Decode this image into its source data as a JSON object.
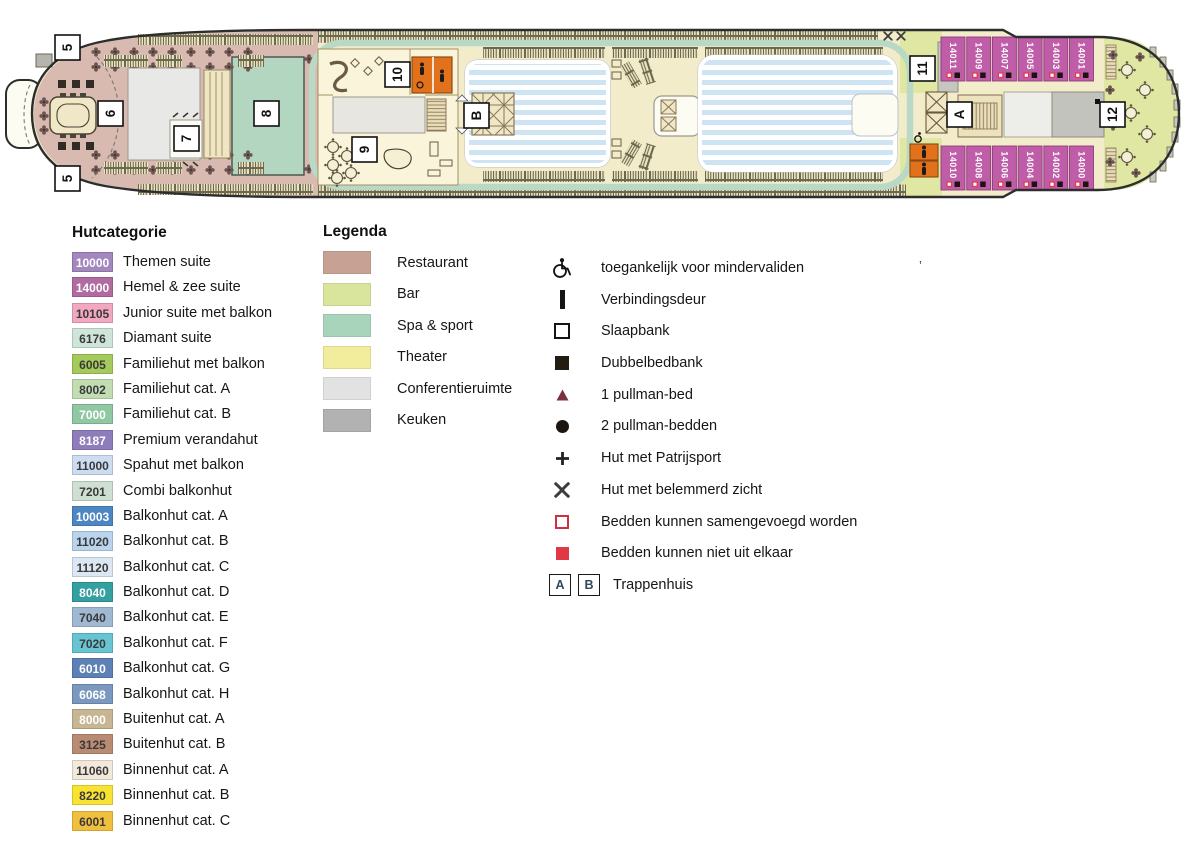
{
  "deck_plan": {
    "markers": [
      {
        "label": "5",
        "x": 55,
        "y": 35
      },
      {
        "label": "5",
        "x": 55,
        "y": 166
      },
      {
        "label": "6",
        "x": 98,
        "y": 101
      },
      {
        "label": "7",
        "x": 174,
        "y": 126
      },
      {
        "label": "8",
        "x": 254,
        "y": 101
      },
      {
        "label": "9",
        "x": 352,
        "y": 137
      },
      {
        "label": "10",
        "x": 385,
        "y": 62
      },
      {
        "label": "11",
        "x": 910,
        "y": 56
      },
      {
        "label": "12",
        "x": 1100,
        "y": 102
      },
      {
        "label": "A",
        "x": 947,
        "y": 102
      },
      {
        "label": "B",
        "x": 464,
        "y": 103
      }
    ],
    "cabins_top": [
      "14011",
      "14009",
      "14007",
      "14005",
      "14003",
      "14001"
    ],
    "cabins_bottom": [
      "14010",
      "14008",
      "14006",
      "14004",
      "14002",
      "14000"
    ],
    "colors": {
      "hull_outline": "#2d2d2d",
      "deck": "#f2ecca",
      "restaurant_area": "#d8bab0",
      "bar_area": "#dfe7a2",
      "spa_area": "#b2d6c0",
      "venue_area": "#faf4da",
      "pool_blue": "#cfe4f3",
      "jogging_track": "#b9d8c5",
      "cabin_suite": "#c05da8",
      "wc_orange": "#e2711c",
      "conference_gray": "#e8e8e6",
      "kitchen_gray": "#c3c3bd",
      "marker_red": "#e8384a"
    }
  },
  "hutcategorie": {
    "title": "Hutcategorie",
    "items": [
      {
        "code": "10000",
        "label": "Themen suite",
        "bg": "#a288bf",
        "fg": "#ffffff"
      },
      {
        "code": "14000",
        "label": "Hemel & zee suite",
        "bg": "#b16ba1",
        "fg": "#ffffff"
      },
      {
        "code": "10105",
        "label": "Junior suite met balkon",
        "bg": "#f2a8c0",
        "fg": "#3a3a3a"
      },
      {
        "code": "6176",
        "label": "Diamant suite",
        "bg": "#cfe5d9",
        "fg": "#3a3a3a"
      },
      {
        "code": "6005",
        "label": "Familiehut met balkon",
        "bg": "#a3ca5b",
        "fg": "#3a3a3a"
      },
      {
        "code": "8002",
        "label": "Familiehut cat. A",
        "bg": "#c2ddb1",
        "fg": "#3a3a3a"
      },
      {
        "code": "7000",
        "label": "Familiehut cat. B",
        "bg": "#90c8a4",
        "fg": "#ffffff"
      },
      {
        "code": "8187",
        "label": "Premium verandahut",
        "bg": "#8f7cba",
        "fg": "#ffffff"
      },
      {
        "code": "11000",
        "label": "Spahut met balkon",
        "bg": "#ccdcf1",
        "fg": "#3a3a3a"
      },
      {
        "code": "7201",
        "label": "Combi balkonhut",
        "bg": "#cfdfd2",
        "fg": "#3a3a3a"
      },
      {
        "code": "10003",
        "label": "Balkonhut cat. A",
        "bg": "#4c86c3",
        "fg": "#ffffff"
      },
      {
        "code": "11020",
        "label": "Balkonhut cat. B",
        "bg": "#b9d4ec",
        "fg": "#3a3a3a"
      },
      {
        "code": "11120",
        "label": "Balkonhut cat. C",
        "bg": "#dde7f3",
        "fg": "#3a3a3a"
      },
      {
        "code": "8040",
        "label": "Balkonhut cat. D",
        "bg": "#34a0a0",
        "fg": "#ffffff"
      },
      {
        "code": "7040",
        "label": "Balkonhut cat. E",
        "bg": "#a0b8d1",
        "fg": "#3a3a3a"
      },
      {
        "code": "7020",
        "label": "Balkonhut cat. F",
        "bg": "#66c4d3",
        "fg": "#3a3a3a"
      },
      {
        "code": "6010",
        "label": "Balkonhut cat. G",
        "bg": "#5d80b5",
        "fg": "#ffffff"
      },
      {
        "code": "6068",
        "label": "Balkonhut cat. H",
        "bg": "#7b98bf",
        "fg": "#ffffff"
      },
      {
        "code": "8000",
        "label": "Buitenhut cat. A",
        "bg": "#c7b694",
        "fg": "#ffffff"
      },
      {
        "code": "3125",
        "label": "Buitenhut cat. B",
        "bg": "#ba8b73",
        "fg": "#3a3a3a"
      },
      {
        "code": "11060",
        "label": "Binnenhut cat. A",
        "bg": "#f3e9da",
        "fg": "#3a3a3a"
      },
      {
        "code": "8220",
        "label": "Binnenhut cat. B",
        "bg": "#f9e332",
        "fg": "#3a3a3a"
      },
      {
        "code": "6001",
        "label": "Binnenhut cat. C",
        "bg": "#f1bf3e",
        "fg": "#3a3a3a"
      }
    ]
  },
  "legenda": {
    "title": "Legenda",
    "items": [
      {
        "label": "Restaurant",
        "color": "#c7a294"
      },
      {
        "label": "Bar",
        "color": "#d9e49c"
      },
      {
        "label": "Spa & sport",
        "color": "#a9d4bc"
      },
      {
        "label": "Theater",
        "color": "#f2ec9d"
      },
      {
        "label": "Conferentieruimte",
        "color": "#e2e2e2"
      },
      {
        "label": "Keuken",
        "color": "#b2b2b2"
      }
    ]
  },
  "symbols": {
    "items": [
      {
        "icon": "wheelchair-icon",
        "label": "toegankelijk voor mindervaliden"
      },
      {
        "icon": "door-bar-icon",
        "label": "Verbindingsdeur"
      },
      {
        "icon": "square-outline-icon",
        "label": "Slaapbank"
      },
      {
        "icon": "square-filled-icon",
        "label": "Dubbelbedbank"
      },
      {
        "icon": "triangle-icon",
        "label": "1 pullman-bed"
      },
      {
        "icon": "circle-icon",
        "label": "2 pullman-bedden"
      },
      {
        "icon": "plus-icon",
        "label": "Hut met Patrijsport"
      },
      {
        "icon": "obstructed-view-icon",
        "label": "Hut met belemmerd zicht"
      },
      {
        "icon": "red-square-outline-icon",
        "label": "Bedden kunnen samengevoegd worden"
      },
      {
        "icon": "red-square-filled-icon",
        "label": "Bedden kunnen niet uit elkaar"
      }
    ],
    "trappenhuis": {
      "boxes": [
        "A",
        "B"
      ],
      "label": "Trappenhuis"
    }
  },
  "stray_mark": "’"
}
